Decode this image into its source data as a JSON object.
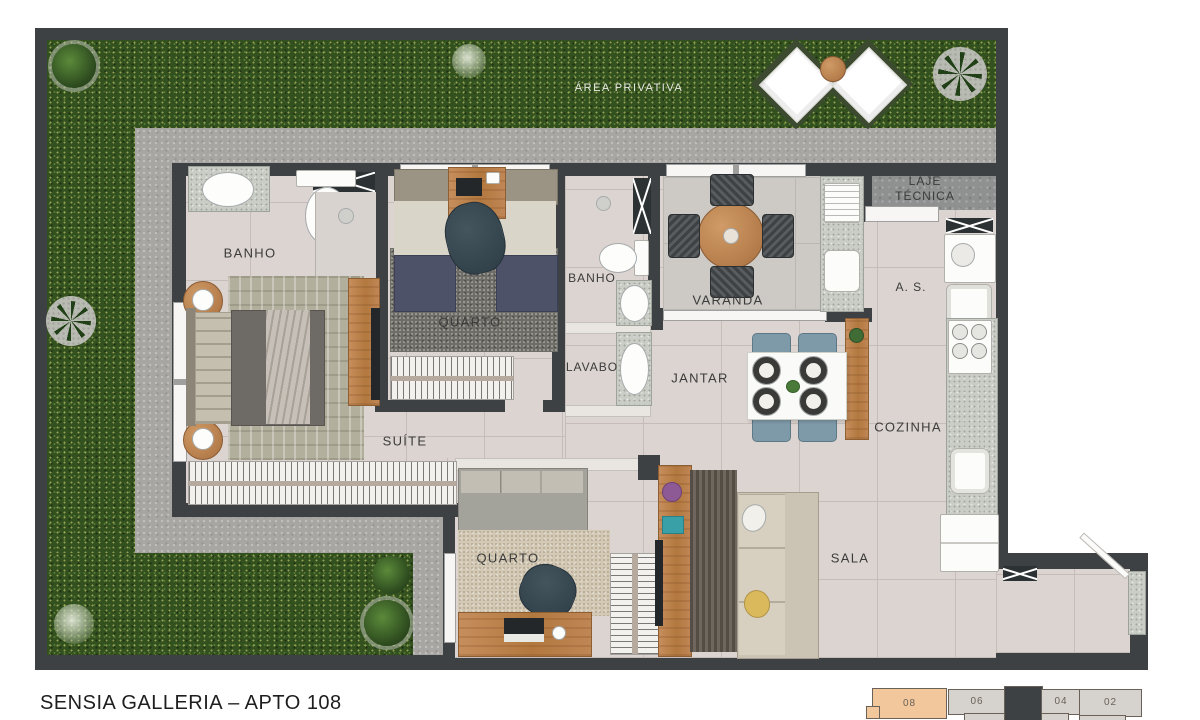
{
  "title": "SENSIA GALLERIA – APTO 108",
  "area_label": "ÁREA PRIVATIVA",
  "rooms": {
    "banho1": "BANHO",
    "quarto1": "QUARTO",
    "banho2": "BANHO",
    "lavabo": "LAVABO",
    "varanda": "VARANDA",
    "jantar": "JANTAR",
    "laje_line1": "LAJE",
    "laje_line2": "TÉCNICA",
    "servico": "A. S.",
    "cozinha": "COZINHA",
    "suite": "SUÍTE",
    "quarto2": "QUARTO",
    "sala": "SALA"
  },
  "key_plan": {
    "units": [
      {
        "label": "08",
        "highlighted": true
      },
      {
        "label": "06",
        "highlighted": false
      },
      {
        "label": "04",
        "highlighted": false
      },
      {
        "label": "02",
        "highlighted": false
      }
    ],
    "highlight_color": "#f3c79c"
  },
  "colors": {
    "wall": "#3d4144",
    "grass": "#33501f",
    "walkway": "#a7a6a3",
    "floor": "#dcd4d0",
    "wood": "#bd8352",
    "highlight_unit": "#f3c79c"
  }
}
